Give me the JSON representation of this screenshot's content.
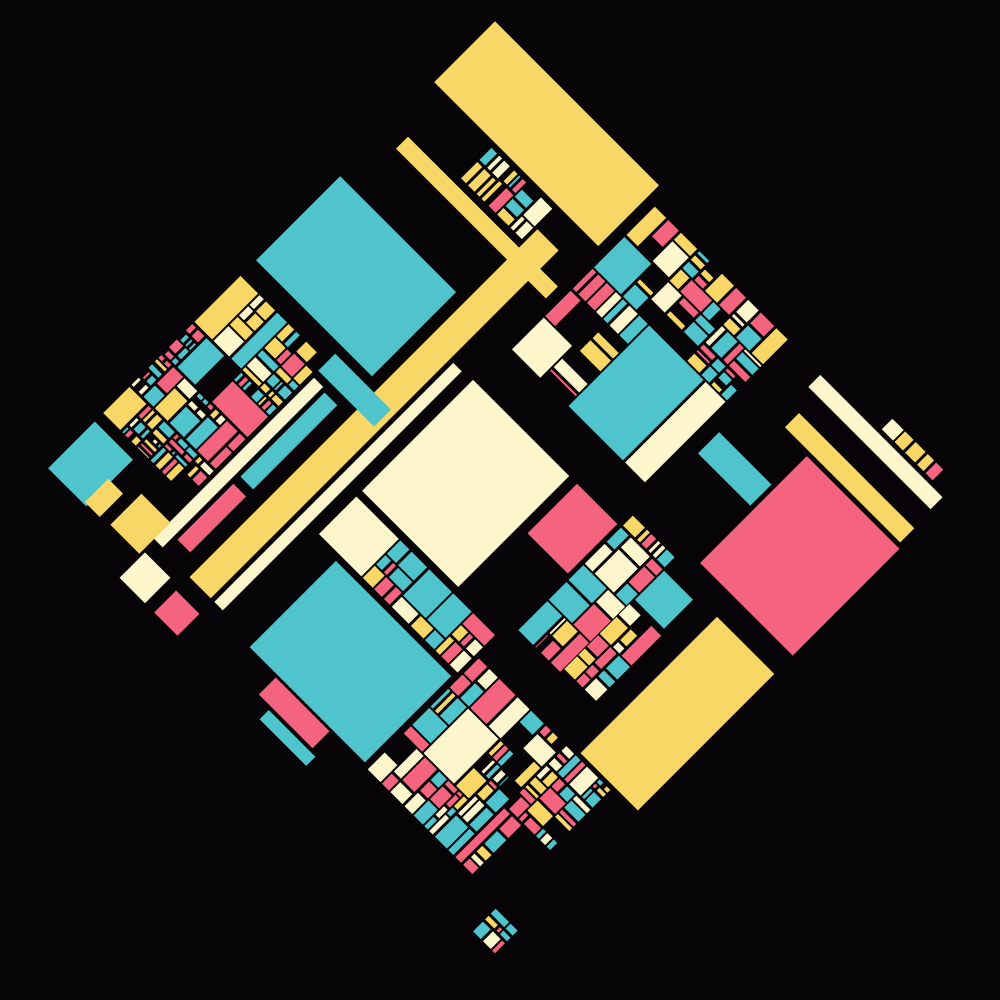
{
  "canvas": {
    "width": 1000,
    "height": 1000,
    "background": "#060406"
  },
  "art": {
    "center_x": 495,
    "center_y": 488,
    "side": 660,
    "rotation_deg": 45,
    "palette": {
      "teal": "#4fc4cd",
      "yellow": "#f8d766",
      "pink": "#f5647f",
      "cream": "#fdf6cd",
      "background": "#060406"
    },
    "mosaic_style": {
      "gap": 2.6,
      "min_cell": 6,
      "hole_prob": 0.1,
      "stop_prob": 0.13,
      "weights": {
        "pink": 0.28,
        "teal": 0.26,
        "yellow": 0.23,
        "cream": 0.23
      }
    },
    "rects": [
      {
        "name": "block-yellow-topleft",
        "x": 0.0,
        "y": 0.0,
        "w": 0.352,
        "h": 0.13,
        "color": "yellow"
      },
      {
        "name": "block-teal-upperleft",
        "x": 0.0,
        "y": 0.332,
        "w": 0.248,
        "h": 0.18,
        "color": "teal"
      },
      {
        "name": "block-cream-center",
        "x": 0.36,
        "y": 0.408,
        "w": 0.206,
        "h": 0.238,
        "color": "cream"
      },
      {
        "name": "block-teal-bottom",
        "x": 0.408,
        "y": 0.748,
        "w": 0.246,
        "h": 0.186,
        "color": "teal"
      },
      {
        "name": "block-pink-right",
        "x": 0.8,
        "y": 0.132,
        "w": 0.198,
        "h": 0.228,
        "color": "pink"
      },
      {
        "name": "block-yellow-bottomright",
        "x": 0.876,
        "y": 0.4,
        "w": 0.122,
        "h": 0.292,
        "color": "yellow"
      },
      {
        "name": "block-pink-center",
        "x": 0.584,
        "y": 0.408,
        "w": 0.086,
        "h": 0.106,
        "color": "pink"
      },
      {
        "name": "block-teal-medium-right",
        "x": 0.77,
        "y": 0.408,
        "w": 0.062,
        "h": 0.062,
        "color": "teal"
      },
      {
        "name": "strip-yellow-top",
        "x": 0.03,
        "y": 0.216,
        "w": 0.322,
        "h": 0.026,
        "color": "yellow"
      },
      {
        "name": "strip-yellow-vertical",
        "x": 0.268,
        "y": 0.178,
        "w": 0.046,
        "h": 0.744,
        "color": "yellow"
      },
      {
        "name": "strip-cream-vertical",
        "x": 0.321,
        "y": 0.41,
        "w": 0.018,
        "h": 0.512,
        "color": "cream"
      },
      {
        "name": "strip-cream-left",
        "x": 0.188,
        "y": 0.575,
        "w": 0.02,
        "h": 0.345,
        "color": "cream"
      },
      {
        "name": "strip-teal-left",
        "x": 0.215,
        "y": 0.58,
        "w": 0.028,
        "h": 0.18,
        "color": "teal"
      },
      {
        "name": "strip-pink-left",
        "x": 0.215,
        "y": 0.775,
        "w": 0.028,
        "h": 0.12,
        "color": "pink"
      },
      {
        "name": "strip-teal-under-b",
        "x": 0.185,
        "y": 0.528,
        "w": 0.12,
        "h": 0.036,
        "color": "teal"
      },
      {
        "name": "strip-cream-topright",
        "x": 0.728,
        "y": 0.03,
        "w": 0.262,
        "h": 0.026,
        "color": "cream"
      },
      {
        "name": "strip-yellow-topright",
        "x": 0.745,
        "y": 0.094,
        "w": 0.248,
        "h": 0.03,
        "color": "yellow"
      },
      {
        "name": "strip-teal-right",
        "x": 0.68,
        "y": 0.2,
        "w": 0.112,
        "h": 0.046,
        "color": "teal"
      },
      {
        "name": "strip-pink-below-d",
        "x": 0.468,
        "y": 0.938,
        "w": 0.115,
        "h": 0.036,
        "color": "pink"
      },
      {
        "name": "strip-teal-below-d",
        "x": 0.495,
        "y": 0.98,
        "w": 0.1,
        "h": 0.02,
        "color": "teal"
      },
      {
        "name": "bit-teal-bottomleft",
        "x": 0.0,
        "y": 0.858,
        "w": 0.082,
        "h": 0.1,
        "color": "teal"
      },
      {
        "name": "bit-yellow-bottomleft",
        "x": 0.128,
        "y": 0.885,
        "w": 0.062,
        "h": 0.066,
        "color": "yellow"
      },
      {
        "name": "bit-cream-bottomleft",
        "x": 0.194,
        "y": 0.944,
        "w": 0.054,
        "h": 0.054,
        "color": "cream"
      },
      {
        "name": "bit-pink-bottomleft",
        "x": 0.268,
        "y": 0.952,
        "w": 0.05,
        "h": 0.046,
        "color": "pink"
      },
      {
        "name": "bit-yellow-small",
        "x": 0.075,
        "y": 0.905,
        "w": 0.032,
        "h": 0.05,
        "color": "yellow"
      }
    ],
    "mosaics": [
      {
        "name": "mosaic-topleft",
        "x": 0.132,
        "y": 0.14,
        "w": 0.13,
        "h": 0.064,
        "seed": 7,
        "depth": 3
      },
      {
        "name": "mosaic-topcenter",
        "x": 0.37,
        "y": 0.028,
        "w": 0.285,
        "h": 0.305,
        "seed": 11,
        "depth": 5
      },
      {
        "name": "mosaic-bottomleft",
        "x": 0.0,
        "y": 0.545,
        "w": 0.18,
        "h": 0.295,
        "seed": 23,
        "depth": 5
      },
      {
        "name": "mosaic-rightcenter",
        "x": 0.678,
        "y": 0.382,
        "w": 0.088,
        "h": 0.245,
        "seed": 31,
        "depth": 4
      },
      {
        "name": "mosaic-centerband",
        "x": 0.36,
        "y": 0.658,
        "w": 0.298,
        "h": 0.08,
        "seed": 41,
        "depth": 4
      },
      {
        "name": "mosaic-bottomright",
        "x": 0.665,
        "y": 0.7,
        "w": 0.282,
        "h": 0.238,
        "seed": 53,
        "depth": 5
      },
      {
        "name": "mosaic-topright-edge",
        "x": 0.852,
        "y": 0.0,
        "w": 0.14,
        "h": 0.022,
        "seed": 61,
        "depth": 2
      },
      {
        "name": "mosaic-bottomright-corner",
        "x": 0.952,
        "y": 0.95,
        "w": 0.046,
        "h": 0.048,
        "seed": 67,
        "depth": 2
      },
      {
        "name": "mosaic-below-teal-medium",
        "x": 0.768,
        "y": 0.48,
        "w": 0.068,
        "h": 0.14,
        "seed": 71,
        "depth": 3
      }
    ]
  }
}
